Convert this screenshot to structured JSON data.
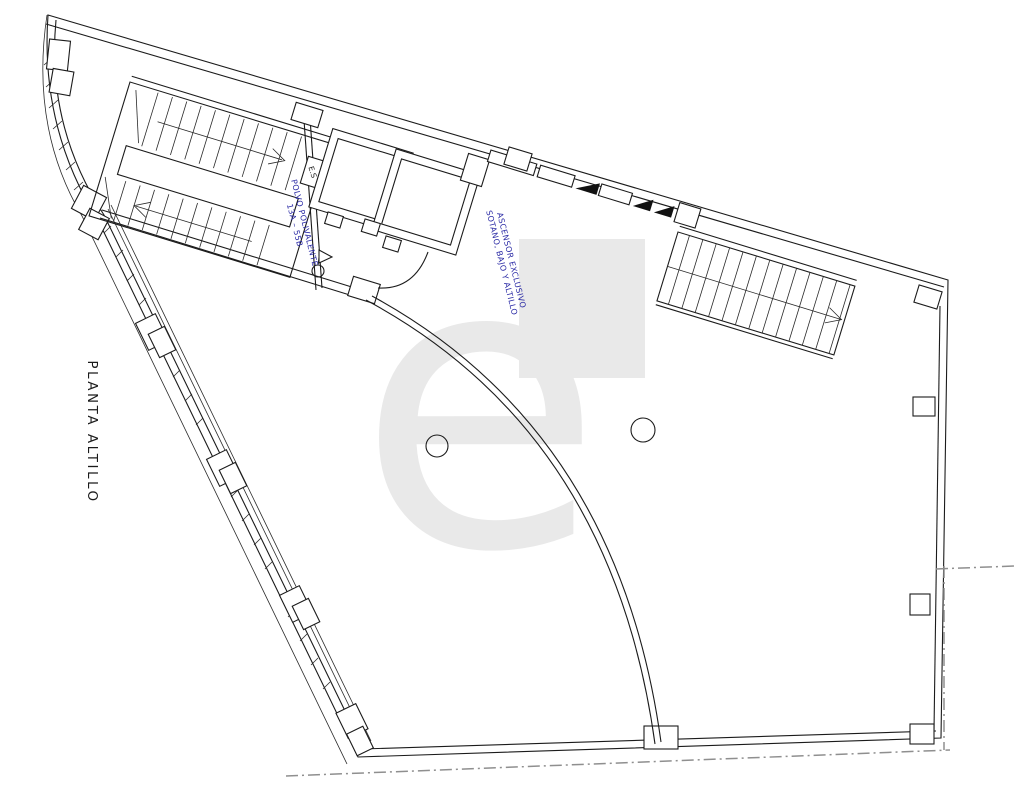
{
  "plan": {
    "title": "PLANTA ALTILLO",
    "labels": {
      "room": {
        "line1": "POLVO POLIVALENTE",
        "line2": "13A – 55B"
      },
      "elevator": {
        "line1": "ASCENSOR EXCLUSIVO",
        "line2": "SOTANO, BAJO Y ALTILLO"
      },
      "stair_door": "E.S"
    },
    "watermark": {
      "letter": "e",
      "color": "#e9e9e9"
    },
    "colors": {
      "line": "#1b1b1b",
      "annotation_blue": "#2a2aa5",
      "dashdot_gray": "#8f8f8f",
      "background": "#ffffff"
    }
  }
}
